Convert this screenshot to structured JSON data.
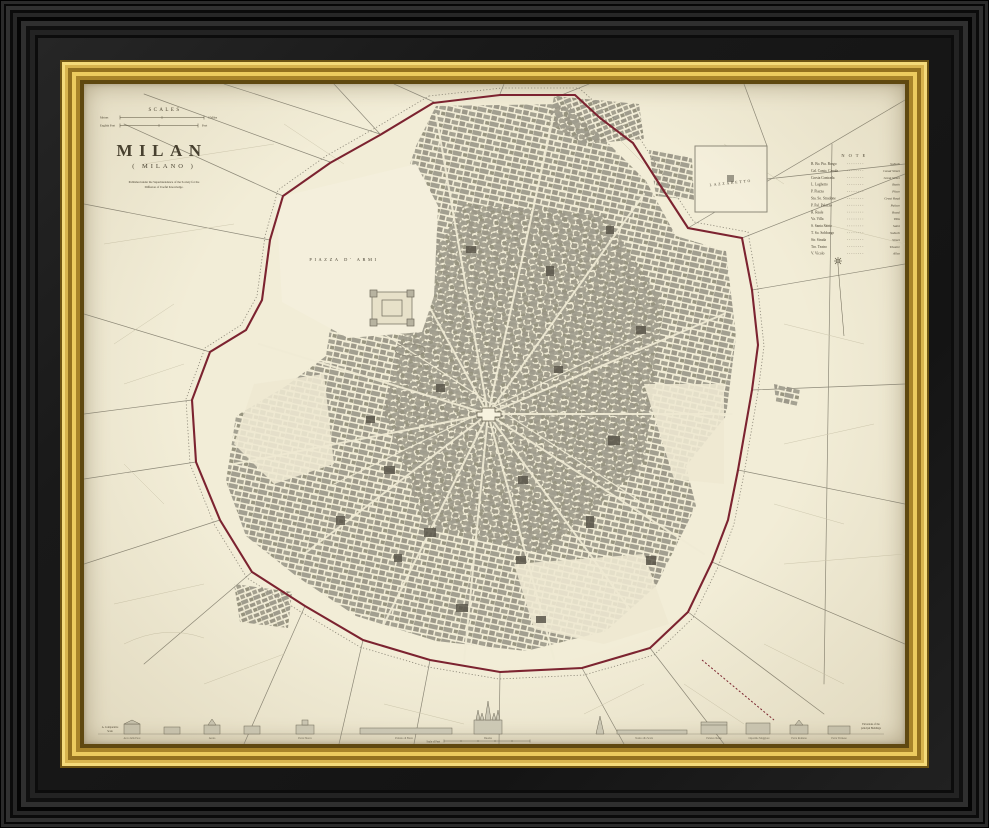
{
  "artwork": {
    "kind": "framed antique engraved city map, black and gilt frame",
    "title": "MILAN",
    "subtitle": "( MILANO )",
    "imprint_line1": "Published under the Superintendence of the Society for the",
    "imprint_line2": "Diffusion of Useful Knowledge.",
    "scales": {
      "heading": "SCALES",
      "bar1_left": "Metres",
      "bar1_right": "3 Miles",
      "bar2_left": "English Feet",
      "bar2_right": "Feet"
    },
    "labels": {
      "piazza_d_armi": "PIAZZA  D'  ARMI",
      "lazzaretto": "LAZZARETTO"
    },
    "note": {
      "title": "N O T E",
      "items": [
        {
          "abbr": "B. Bo. Pta. Borgo",
          "meaning": "Suburb"
        },
        {
          "abbr": "Cal. Canto. Canale",
          "meaning": "Canal Street"
        },
        {
          "abbr": "Corsia Contrada",
          "meaning": "Great Street"
        },
        {
          "abbr": "L. Laghetto",
          "meaning": "Basin"
        },
        {
          "abbr": "P. Piazza",
          "meaning": "Place"
        },
        {
          "abbr": "Sta. So. Stradone",
          "meaning": "Great Road"
        },
        {
          "abbr": "P. Pal. Palazzo",
          "meaning": "Palace"
        },
        {
          "abbr": "R. Reale",
          "meaning": "Royal"
        },
        {
          "abbr": "Va. Villa",
          "meaning": "Villa"
        },
        {
          "abbr": "S. Santa Santo",
          "meaning": "Saint"
        },
        {
          "abbr": "T. So. Sobborgo",
          "meaning": "Suburb"
        },
        {
          "abbr": "Str. Strada",
          "meaning": "Street"
        },
        {
          "abbr": "Tro. Teatro",
          "meaning": "Theatre"
        },
        {
          "abbr": "V. Vicolo",
          "meaning": "Alley"
        }
      ]
    },
    "elevations": {
      "captions": [
        "Arco della Pace",
        "Arena",
        "Porta Nuova",
        "Palazzo di Brera",
        "Duomo",
        "Teatro alla Scala",
        "Palazzo Reale",
        "Ospedale Maggiore",
        "Porta Romana",
        "Porta Ticinese"
      ],
      "left_note_line1": "A. Comparative",
      "left_note_line2": "Scale",
      "right_note_line1": "Elevations of the",
      "right_note_line2": "principal Buildings",
      "scale_label": "Scale of Feet"
    },
    "colors": {
      "frame_black": "#131313",
      "frame_gold": "#d7b44a",
      "paper": "#f2edd7",
      "wall_red": "#7c2330",
      "block_gray": "#a29f90",
      "ink": "#453f30"
    }
  }
}
